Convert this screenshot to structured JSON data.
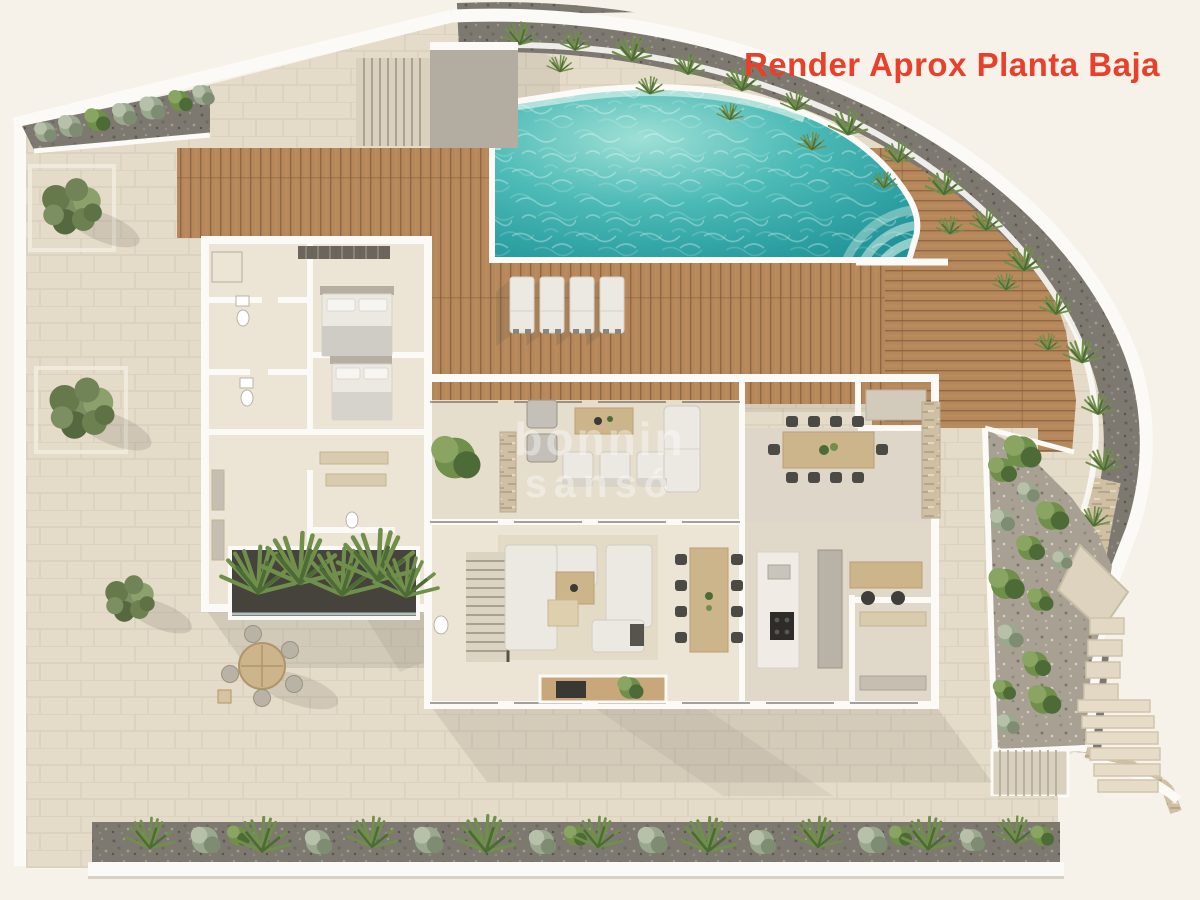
{
  "title": {
    "text": "Render Aprox Planta Baja"
  },
  "watermark": {
    "line1": "bonnin",
    "line2": "sansó"
  },
  "colors": {
    "page_bg": "#f6f2ea",
    "accent": "#e8402a",
    "stone": "#e4dbc8",
    "wall_white": "#fbfaf6",
    "floor_cream": "#ece4d4",
    "floor_lounge": "#e6decd",
    "deck_wood": "#b5875a",
    "deck_wood_dark": "#8a6240",
    "pool_deep": "#1f9399",
    "pool_mid": "#4cbab6",
    "pool_light": "#9fe0d6",
    "pool_tile": "#bfe7e1",
    "gravel_dark": "#7d7970",
    "gravel_light": "#a8a193",
    "rubble_tan": "#cfc0a4",
    "plant_green": "#6f8f4a",
    "plant_dark": "#4d6b36",
    "plant_gray": "#9aa88e",
    "furniture_white": "#ece9e3",
    "furniture_gray": "#b9b3a6",
    "wood_furniture": "#cdb58b",
    "planter_dark": "#45433c",
    "shadow": "#5f5a50"
  }
}
